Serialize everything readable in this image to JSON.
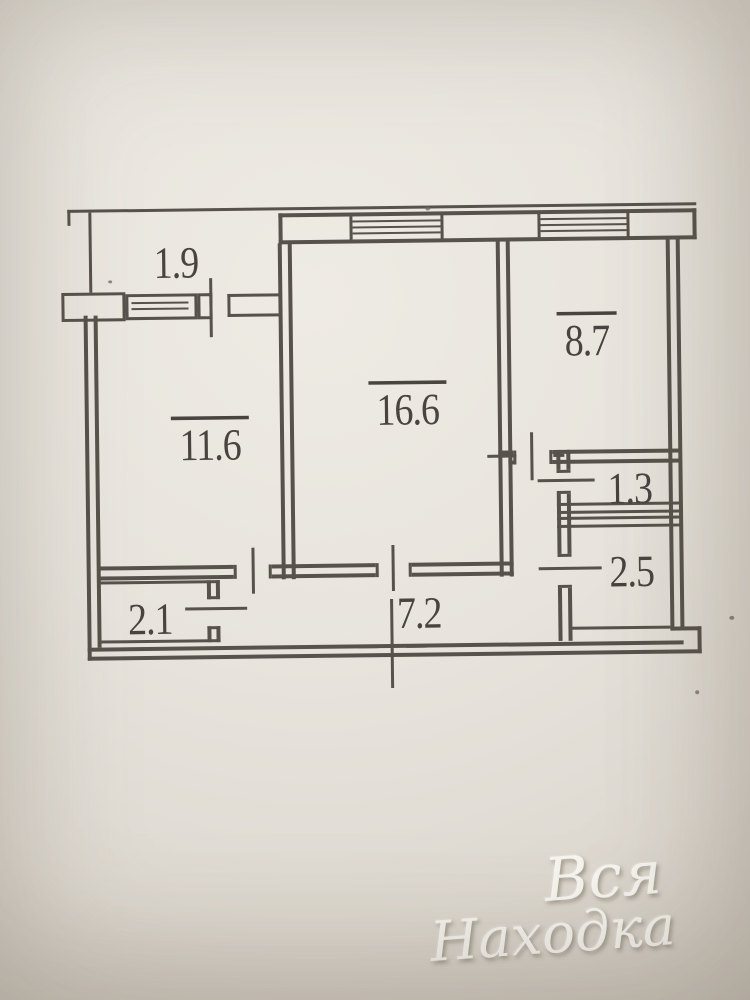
{
  "document": {
    "kind": "apartment floor plan photo (BTI technical passport drawing)",
    "ink_color": "#57524b",
    "paper_color": "#e8e4dd",
    "label_color": "#4a4440"
  },
  "floorplan": {
    "rooms": [
      {
        "name": "balcony",
        "area": "1.9",
        "area_overlined": false
      },
      {
        "name": "room-left",
        "area": "11.6",
        "area_overlined": true
      },
      {
        "name": "room-center",
        "area": "16.6",
        "area_overlined": true
      },
      {
        "name": "kitchen",
        "area": "8.7",
        "area_overlined": true
      },
      {
        "name": "wc",
        "area": "1.3",
        "area_overlined": false
      },
      {
        "name": "bathroom",
        "area": "2.5",
        "area_overlined": false
      },
      {
        "name": "closet",
        "area": "2.1",
        "area_overlined": false
      },
      {
        "name": "hallway",
        "area": "7.2",
        "area_overlined": false
      }
    ]
  },
  "watermark": {
    "line1": "Вся",
    "line2": "Находка",
    "color": "#f8f5ef"
  }
}
